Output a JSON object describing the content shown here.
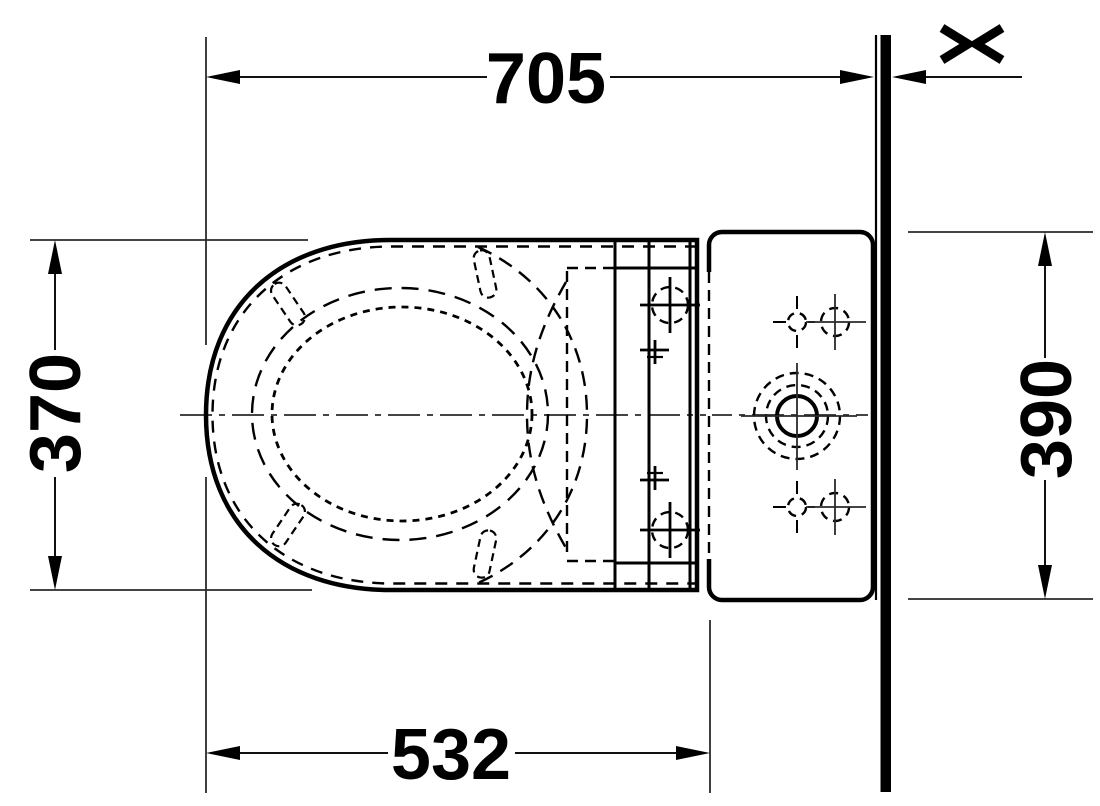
{
  "drawing": {
    "kind": "technical-plan-view",
    "background_color": "#ffffff",
    "line_color": "#000000",
    "dimensions": {
      "total_depth": {
        "value": "705",
        "orientation": "horizontal",
        "position": "top"
      },
      "seat_width": {
        "value": "370",
        "orientation": "vertical",
        "position": "left"
      },
      "tank_width": {
        "value": "390",
        "orientation": "vertical",
        "position": "right"
      },
      "bowl_depth": {
        "value": "532",
        "orientation": "horizontal",
        "position": "bottom"
      }
    },
    "wall": {
      "break_symbol": "><"
    }
  }
}
